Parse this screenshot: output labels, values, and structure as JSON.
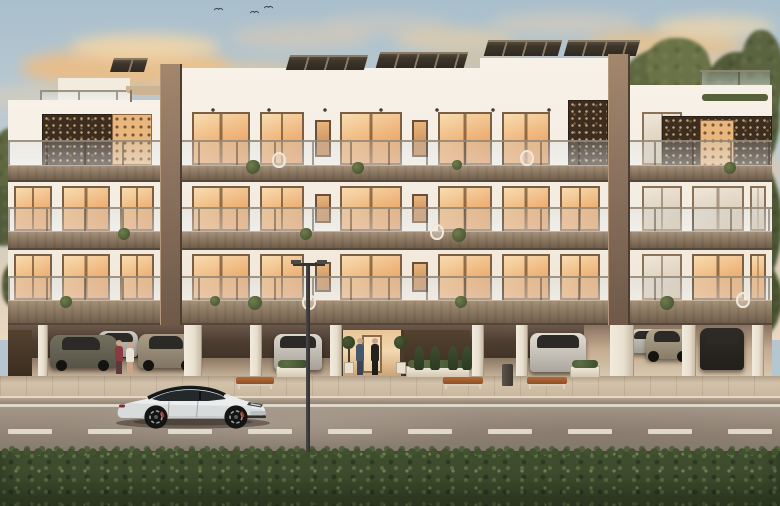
{
  "meta": {
    "title": "Architectural rendering — modern three-storey apartment building at dusk",
    "type": "photorealistic exterior visualization, no UI text visible"
  },
  "scene": {
    "description": "Dusk rendering of a white three-storey apartment block with bronze perforated screens, glowing amber windows, rooftop solar panels, open ground-floor parking with cars and people, a street lamp, a white sports sedan parked on the road, and a green hedge in the foreground.",
    "inventory": {
      "people_count": 4,
      "garage_cars_count": 8,
      "street_cars_count": 1,
      "benches_count": 3,
      "lamp_posts_count": 1,
      "birds_count": 3
    },
    "palette": {
      "sky_top": "#a9bfcc",
      "sky_mid": "#c3ccce",
      "sky_horizon": "#ead8c0",
      "cloud_warm": "#f0bd82",
      "facade_white": "#f4ede2",
      "facade_shadow": "#e4d6c3",
      "slab_brown": "#8d7963",
      "pier_brown": "#8d7460",
      "screen_dark": "#3c2d21",
      "window_glow": "#eeb277",
      "window_frame": "#7a5f45",
      "glass_rail": "#dce8ee",
      "garage_dark": "#3a2e25",
      "sidewalk": "#cfbda7",
      "road": "#948779",
      "road_line": "#e9e2d4",
      "hedge_green": "#3f4d2f",
      "tree_olive": "#5a6440",
      "solar_panel": "#3e362b"
    },
    "sky": {
      "clouds": [
        {
          "x": 20,
          "y": 48,
          "w": 210,
          "h": 40,
          "c": "#f0bd82",
          "o": 0.85
        },
        {
          "x": 70,
          "y": 34,
          "w": 150,
          "h": 26,
          "c": "#f6d8a8",
          "o": 0.8
        },
        {
          "x": 150,
          "y": 62,
          "w": 180,
          "h": 26,
          "c": "#ecc68f",
          "o": 0.6
        },
        {
          "x": 230,
          "y": 24,
          "w": 140,
          "h": 26,
          "c": "#e2cbae",
          "o": 0.5
        },
        {
          "x": 320,
          "y": 14,
          "w": 130,
          "h": 22,
          "c": "#ddccb8",
          "o": 0.45
        },
        {
          "x": 395,
          "y": 28,
          "w": 120,
          "h": 24,
          "c": "#efcf9e",
          "o": 0.6
        },
        {
          "x": 430,
          "y": 52,
          "w": 100,
          "h": 18,
          "c": "#ecc088",
          "o": 0.5
        },
        {
          "x": 490,
          "y": 12,
          "w": 150,
          "h": 24,
          "c": "#e4cfb3",
          "o": 0.5
        },
        {
          "x": 585,
          "y": 30,
          "w": 160,
          "h": 30,
          "c": "#f0c285",
          "o": 0.75
        },
        {
          "x": 655,
          "y": 16,
          "w": 120,
          "h": 22,
          "c": "#f4d9ac",
          "o": 0.7
        },
        {
          "x": 690,
          "y": 56,
          "w": 90,
          "h": 18,
          "c": "#f2cd9a",
          "o": 0.6
        },
        {
          "x": -20,
          "y": 84,
          "w": 140,
          "h": 26,
          "c": "#ead0ad",
          "o": 0.45
        },
        {
          "x": 700,
          "y": 140,
          "w": 80,
          "h": 60,
          "c": "#efc893",
          "o": 0.5
        }
      ],
      "birds": [
        {
          "x": 214,
          "y": 7
        },
        {
          "x": 250,
          "y": 10
        },
        {
          "x": 264,
          "y": 5
        }
      ]
    },
    "trees": {
      "blobs": [
        {
          "x": 598,
          "y": 86,
          "w": 64,
          "h": 64,
          "c": "#565f3b"
        },
        {
          "x": 618,
          "y": 48,
          "w": 104,
          "h": 96,
          "c": "#5f6941"
        },
        {
          "x": 646,
          "y": 38,
          "w": 64,
          "h": 54,
          "c": "#6a7347"
        },
        {
          "x": 700,
          "y": 52,
          "w": 80,
          "h": 130,
          "c": "#515b39"
        },
        {
          "x": 740,
          "y": 30,
          "w": 44,
          "h": 90,
          "c": "#5a6440"
        },
        {
          "x": 702,
          "y": 150,
          "w": 80,
          "h": 150,
          "c": "#4d5736"
        },
        {
          "x": 728,
          "y": 260,
          "w": 54,
          "h": 80,
          "c": "#46502f"
        },
        {
          "x": -10,
          "y": 128,
          "w": 46,
          "h": 78,
          "c": "#5e6840"
        },
        {
          "x": -14,
          "y": 186,
          "w": 40,
          "h": 60,
          "c": "#525c3a"
        },
        {
          "x": 2,
          "y": 262,
          "w": 30,
          "h": 46,
          "c": "#4c5634"
        }
      ],
      "trunks": [
        {
          "x": 730,
          "y": 160,
          "h": 150
        },
        {
          "x": 15,
          "y": 196,
          "h": 80
        }
      ]
    },
    "building": {
      "sections": [
        {
          "name": "left-wing",
          "x": 8,
          "w": 152,
          "top": 100
        },
        {
          "name": "center-a",
          "x": 160,
          "w": 320,
          "top": 68
        },
        {
          "name": "center-b",
          "x": 480,
          "w": 150,
          "top": 58
        },
        {
          "name": "right-wing",
          "x": 630,
          "w": 142,
          "top": 85
        }
      ],
      "piers": [
        {
          "x": 160,
          "w": 22,
          "top": 64
        },
        {
          "x": 608,
          "w": 22,
          "top": 54
        }
      ],
      "slabs": [
        {
          "y": 165,
          "h": 17
        },
        {
          "y": 231,
          "h": 19
        },
        {
          "y": 300,
          "h": 25
        }
      ],
      "railings": [
        {
          "y": 140,
          "h": 25
        },
        {
          "y": 207,
          "h": 24
        },
        {
          "y": 276,
          "h": 24
        }
      ],
      "roof_railings": [
        {
          "x": 40,
          "y": 90,
          "w": 88,
          "h": 10
        },
        {
          "x": 700,
          "y": 70,
          "w": 70,
          "h": 15
        }
      ],
      "roof_planter": {
        "x": 702,
        "y": 94,
        "w": 66,
        "h": 7
      },
      "penthouse": {
        "x": 58,
        "y": 78,
        "w": 72,
        "h": 22
      },
      "pergola": {
        "x": 126,
        "y": 86,
        "w": 46,
        "h": 9,
        "posts": [
          130,
          168
        ]
      },
      "solar": [
        {
          "x": 112,
          "y": 58,
          "w": 34,
          "h": 14
        },
        {
          "x": 288,
          "y": 55,
          "w": 78,
          "h": 15
        },
        {
          "x": 378,
          "y": 52,
          "w": 88,
          "h": 16
        },
        {
          "x": 486,
          "y": 40,
          "w": 74,
          "h": 16
        },
        {
          "x": 566,
          "y": 40,
          "w": 72,
          "h": 16
        }
      ],
      "screens": [
        {
          "x": 42,
          "y": 114,
          "w": 76,
          "h": 51,
          "lit": false
        },
        {
          "x": 112,
          "y": 114,
          "w": 40,
          "h": 51,
          "lit": true
        },
        {
          "x": 568,
          "y": 100,
          "w": 40,
          "h": 65,
          "lit": false
        },
        {
          "x": 662,
          "y": 116,
          "w": 110,
          "h": 54,
          "lit": false
        },
        {
          "x": 700,
          "y": 120,
          "w": 34,
          "h": 46,
          "lit": true
        }
      ],
      "window_rows": [
        {
          "y": 112,
          "h": 53,
          "items": [
            [
              192,
              58,
              "warm"
            ],
            [
              260,
              44,
              "warm"
            ],
            [
              315,
              16,
              "small"
            ],
            [
              340,
              62,
              "warm"
            ],
            [
              412,
              16,
              "small"
            ],
            [
              438,
              54,
              "warm"
            ],
            [
              502,
              48,
              "warm"
            ],
            [
              642,
              40,
              "pale"
            ]
          ]
        },
        {
          "y": 186,
          "h": 45,
          "items": [
            [
              14,
              38,
              "warm"
            ],
            [
              62,
              48,
              "warm"
            ],
            [
              120,
              34,
              "warm"
            ],
            [
              192,
              58,
              "warm"
            ],
            [
              260,
              44,
              "warm"
            ],
            [
              315,
              16,
              "small"
            ],
            [
              340,
              62,
              "warm"
            ],
            [
              412,
              16,
              "small"
            ],
            [
              438,
              54,
              "warm"
            ],
            [
              502,
              48,
              "warm"
            ],
            [
              560,
              40,
              "warm"
            ],
            [
              642,
              40,
              "pale"
            ],
            [
              692,
              52,
              "pale"
            ],
            [
              750,
              16,
              "pale"
            ]
          ]
        },
        {
          "y": 254,
          "h": 46,
          "items": [
            [
              14,
              38,
              "warm"
            ],
            [
              62,
              48,
              "warm"
            ],
            [
              120,
              34,
              "warm"
            ],
            [
              192,
              58,
              "warm"
            ],
            [
              260,
              44,
              "warm"
            ],
            [
              315,
              16,
              "small"
            ],
            [
              340,
              62,
              "warm"
            ],
            [
              412,
              16,
              "small"
            ],
            [
              438,
              54,
              "warm"
            ],
            [
              502,
              48,
              "warm"
            ],
            [
              560,
              40,
              "warm"
            ],
            [
              642,
              40,
              "pale"
            ],
            [
              692,
              52,
              "warm"
            ],
            [
              750,
              16,
              "warm"
            ]
          ]
        }
      ],
      "spot_rows": [
        {
          "y": 108,
          "x": 185,
          "w": 420
        },
        {
          "y": 178,
          "x": 10,
          "w": 760
        },
        {
          "y": 246,
          "x": 10,
          "w": 760
        }
      ],
      "balcony_plants": [
        [
          246,
          160,
          7
        ],
        [
          352,
          162,
          6
        ],
        [
          452,
          160,
          5
        ],
        [
          118,
          228,
          6
        ],
        [
          300,
          228,
          6
        ],
        [
          452,
          228,
          7
        ],
        [
          60,
          296,
          6
        ],
        [
          248,
          296,
          7
        ],
        [
          455,
          296,
          6
        ],
        [
          660,
          296,
          7
        ],
        [
          724,
          162,
          6
        ],
        [
          210,
          296,
          5
        ]
      ],
      "egg_chairs": [
        [
          272,
          152
        ],
        [
          430,
          224
        ],
        [
          520,
          150
        ],
        [
          302,
          294
        ],
        [
          736,
          292
        ]
      ]
    },
    "garage": {
      "y": 325,
      "h": 53,
      "light_zone": {
        "x": 584,
        "w": 188
      },
      "dark_walls": [
        {
          "x": 8,
          "w": 24
        },
        {
          "x": 404,
          "w": 66
        }
      ],
      "entrance": {
        "x": 340,
        "w": 64
      },
      "columns": [
        [
          38,
          10
        ],
        [
          184,
          18
        ],
        [
          250,
          12
        ],
        [
          330,
          12
        ],
        [
          472,
          12
        ],
        [
          516,
          12
        ],
        [
          610,
          24
        ],
        [
          682,
          14
        ],
        [
          752,
          12
        ]
      ],
      "cars": [
        {
          "style": "rear",
          "x": 98,
          "y": 331,
          "w": 40,
          "h": 26,
          "c": "#cfc9bf"
        },
        {
          "style": "side",
          "x": 50,
          "y": 335,
          "w": 68,
          "h": 33,
          "c": "#73705f"
        },
        {
          "style": "side",
          "x": 138,
          "y": 334,
          "w": 62,
          "h": 34,
          "c": "#ab9d85"
        },
        {
          "style": "rear",
          "x": 274,
          "y": 334,
          "w": 48,
          "h": 36,
          "c": "#dcd7cd"
        },
        {
          "style": "rear",
          "x": 630,
          "y": 329,
          "w": 34,
          "h": 24,
          "c": "#d6d0c6"
        },
        {
          "style": "rear",
          "x": 530,
          "y": 333,
          "w": 56,
          "h": 39,
          "c": "#e3ded4"
        },
        {
          "style": "side",
          "x": 646,
          "y": 329,
          "w": 46,
          "h": 30,
          "c": "#b4a68d"
        },
        {
          "style": "rear",
          "x": 700,
          "y": 328,
          "w": 44,
          "h": 42,
          "c": "#2e2a26"
        }
      ],
      "topiaries": [
        {
          "x": 342
        },
        {
          "x": 394
        }
      ],
      "people": [
        {
          "x": 115,
          "y": 340,
          "h": 33,
          "top": "#8a3a40",
          "legs": "#5a3a3a"
        },
        {
          "x": 126,
          "y": 342,
          "h": 31,
          "top": "#e9e2d6",
          "legs": "#caa58a"
        },
        {
          "x": 356,
          "y": 338,
          "h": 37,
          "top": "#46566b",
          "legs": "#3a4452"
        },
        {
          "x": 371,
          "y": 338,
          "h": 37,
          "top": "#24221f",
          "legs": "#1f1d1b"
        }
      ]
    },
    "streetscape": {
      "sidewalk": {
        "y": 376,
        "h": 28
      },
      "benches": [
        {
          "x": 236,
          "w": 38
        },
        {
          "x": 443,
          "w": 40
        },
        {
          "x": 527,
          "w": 40
        }
      ],
      "planters": [
        {
          "x": 276,
          "w": 34
        },
        {
          "x": 406,
          "w": 64
        },
        {
          "x": 570,
          "w": 30
        }
      ],
      "conifers": [
        414,
        430,
        448,
        462
      ],
      "bin": {
        "x": 502,
        "y": 364,
        "w": 11,
        "h": 22
      },
      "lamp": {
        "x": 306,
        "top": 260,
        "bottom": 452
      }
    },
    "road": {
      "y": 404,
      "h": 47,
      "top_line_y": 404,
      "dash_y": 429,
      "dash_w": 44,
      "dash_xs": [
        8,
        88,
        168,
        248,
        328,
        408,
        488,
        568,
        648,
        728
      ]
    },
    "hedge": {
      "y": 451
    },
    "hero_car": {
      "description": "white electric sports sedan parked facing right",
      "x": 112,
      "y": 378,
      "w": 162,
      "h": 52,
      "body": "#eaeced",
      "body_shade": "#c9cecd",
      "glass": "#23282b",
      "roof": "#15181a",
      "wheel": "#141414",
      "rim": "#9aa0a2",
      "caliper": "#b23a34",
      "grille": "#b9bec1"
    }
  }
}
